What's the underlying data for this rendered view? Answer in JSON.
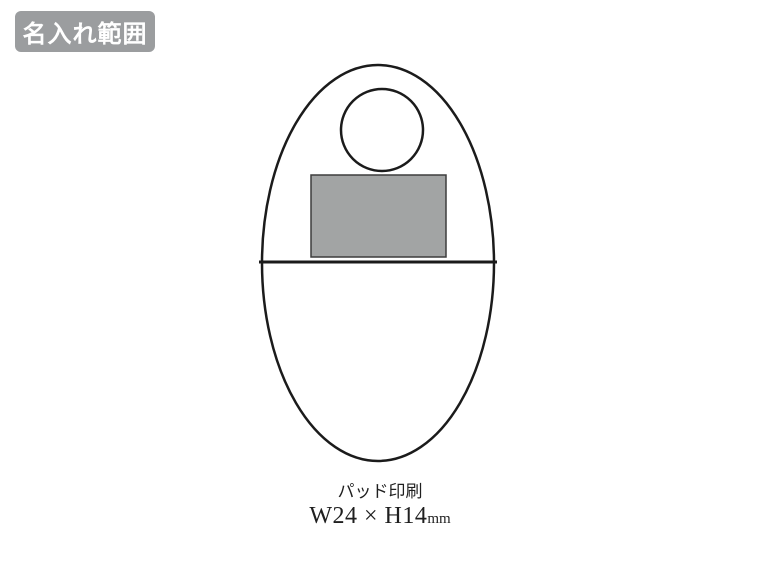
{
  "label": {
    "text": "名入れ範囲"
  },
  "diagram": {
    "shapes": [
      "egg-shaped-product-outline",
      "top-circle-hole",
      "print-area-rectangle",
      "horizontal-seam-line"
    ],
    "print_area": {
      "width_mm": 24,
      "height_mm": 14
    }
  },
  "caption": {
    "method": "パッド印刷",
    "size": "W24 × H14",
    "unit": "mm"
  },
  "colors": {
    "background": "#ffffff",
    "label_bg": "#9b9d9f",
    "label_text": "#ffffff",
    "outline_stroke": "#1b1b1b",
    "print_area_fill": "#a2a4a4",
    "print_area_border": "#3d3d3d",
    "caption_text": "#1f1f1f"
  }
}
